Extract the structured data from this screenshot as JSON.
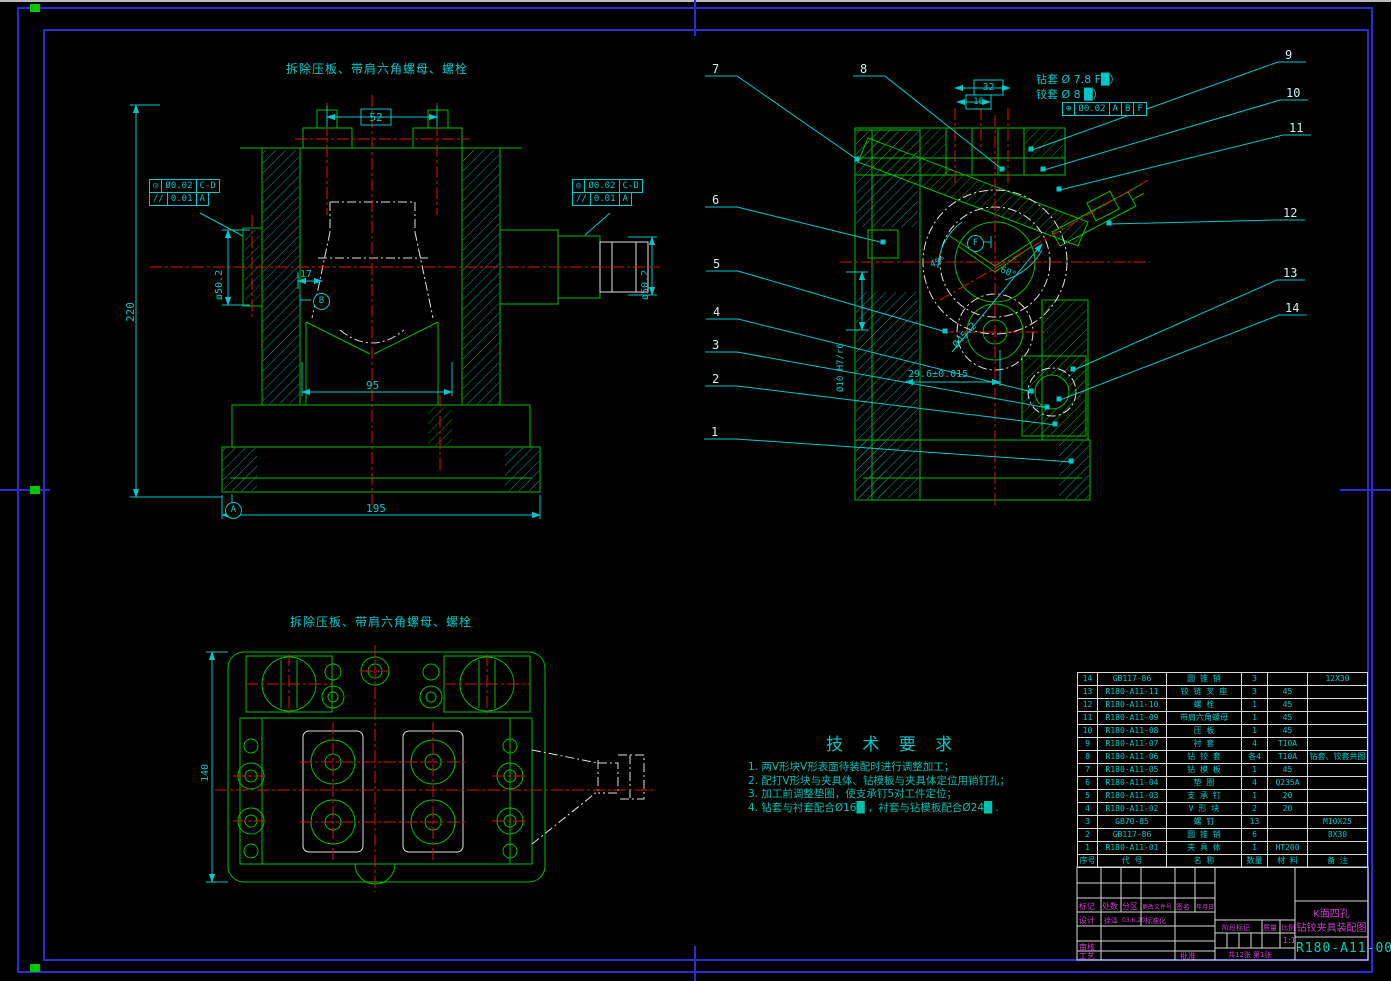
{
  "colors": {
    "line_green": "#00BE00",
    "centerline_red": "#DE1010",
    "dim_cyan": "#00C8C8",
    "phantom_white": "#E0E0E0",
    "frame_blue": "#2B2BD5",
    "label_magenta": "#D23CD2"
  },
  "notes": {
    "front": "拆除压板、带肩六角螺母、螺栓",
    "plan": "拆除压板、带肩六角螺母、螺栓"
  },
  "front_view": {
    "dim_52": "52",
    "dim_17": "17",
    "dim_220": "220",
    "dim_95": "95",
    "dim_195": "195",
    "dia_shaft": "ø50.2",
    "fcf": {
      "con_sym": "◎",
      "con_tol": "Ø0.02",
      "con_ref": "C-D",
      "par_sym": "//",
      "par_tol": "0.01",
      "par_ref": "A"
    }
  },
  "side_view": {
    "dim_32": "32",
    "dim_16": "16",
    "drill_note": "钻套 Ø 7.8 F█）",
    "ream_note": "铰套 Ø 8 █）",
    "fcf": {
      "sym": "⊕",
      "tol": "Ø0.02",
      "d1": "A",
      "d2": "B",
      "d3": "F"
    },
    "ang45": "45°",
    "ang60": "60°",
    "dia452": "Ø45.2",
    "pin_fit": "Ø10 H7/r6",
    "dim_296": "29.6±0.015"
  },
  "plan_view": {
    "dim_140": "140"
  },
  "datums": {
    "a": "A",
    "b": "B",
    "f": "F"
  },
  "balloons": [
    "1",
    "2",
    "3",
    "4",
    "5",
    "6",
    "7",
    "8",
    "9",
    "10",
    "11",
    "12",
    "13",
    "14"
  ],
  "tech_req": {
    "title": "技 术 要 求",
    "items": [
      "1. 两V形块V形表面待装配时进行调整加工；",
      "2. 配打V形块与夹具体、钻模板与夹具体定位用销钉孔；",
      "3. 加工前调整垫圈，使支承钉5对工件定位；",
      "4. 钻套与衬套配合Ø16█ ，衬套与钻模板配合Ø24█ ."
    ]
  },
  "bom": {
    "headers": [
      "序号",
      "代  号",
      "名  称",
      "数量",
      "材  料",
      "备  注"
    ],
    "rows": [
      [
        "14",
        "GB117-86",
        "圆 锥 销",
        "3",
        "",
        "12X30"
      ],
      [
        "13",
        "R180-A11-11",
        "铰 链 叉 座",
        "3",
        "45",
        ""
      ],
      [
        "12",
        "R180-A11-10",
        "螺  栓",
        "1",
        "45",
        ""
      ],
      [
        "11",
        "R180-A11-09",
        "带肩六角螺母",
        "1",
        "45",
        ""
      ],
      [
        "10",
        "R180-A11-08",
        "压  板",
        "1",
        "45",
        ""
      ],
      [
        "9",
        "R180-A11-07",
        "衬  套",
        "4",
        "T10A",
        ""
      ],
      [
        "8",
        "R180-A11-06",
        "钻 铰 套",
        "各4",
        "T10A",
        "钻套、铰套共图"
      ],
      [
        "7",
        "R180-A11-05",
        "钻 模 板",
        "1",
        "45",
        ""
      ],
      [
        "6",
        "R180-A11-04",
        "垫  圈",
        "4",
        "Q235A",
        ""
      ],
      [
        "5",
        "R180-A11-03",
        "支 承 钉",
        "1",
        "20",
        ""
      ],
      [
        "4",
        "R180-A11-02",
        "V 形 块",
        "2",
        "20",
        ""
      ],
      [
        "3",
        "GB70-85",
        "螺  钉",
        "13",
        "",
        "M10X25"
      ],
      [
        "2",
        "GB117-86",
        "圆 锥 销",
        "6",
        "",
        "8X30"
      ],
      [
        "1",
        "R180-A11-01",
        "夹 具 体",
        "1",
        "HT200",
        ""
      ]
    ]
  },
  "title_block": {
    "rev_headers": {
      "mark": "标记",
      "count": "处数",
      "zone": "分区",
      "file_no": "更改文件号",
      "sign": "签名",
      "date": "年月日"
    },
    "design_label": "设计",
    "design_name": "徐泽",
    "design_date": "03.6.20",
    "std_label": "标准化",
    "audit_label": "审核",
    "process_label": "工艺",
    "approve_label": "批准",
    "stage_label": "阶段标记",
    "weight_label": "质量",
    "scale_label": "比例",
    "scale_value": "1:1",
    "sheet_info": "共12张 第1张",
    "title_line1": "K面四孔",
    "title_line2": "钻铰夹具装配图",
    "drawing_no": "R180-A11-00"
  }
}
